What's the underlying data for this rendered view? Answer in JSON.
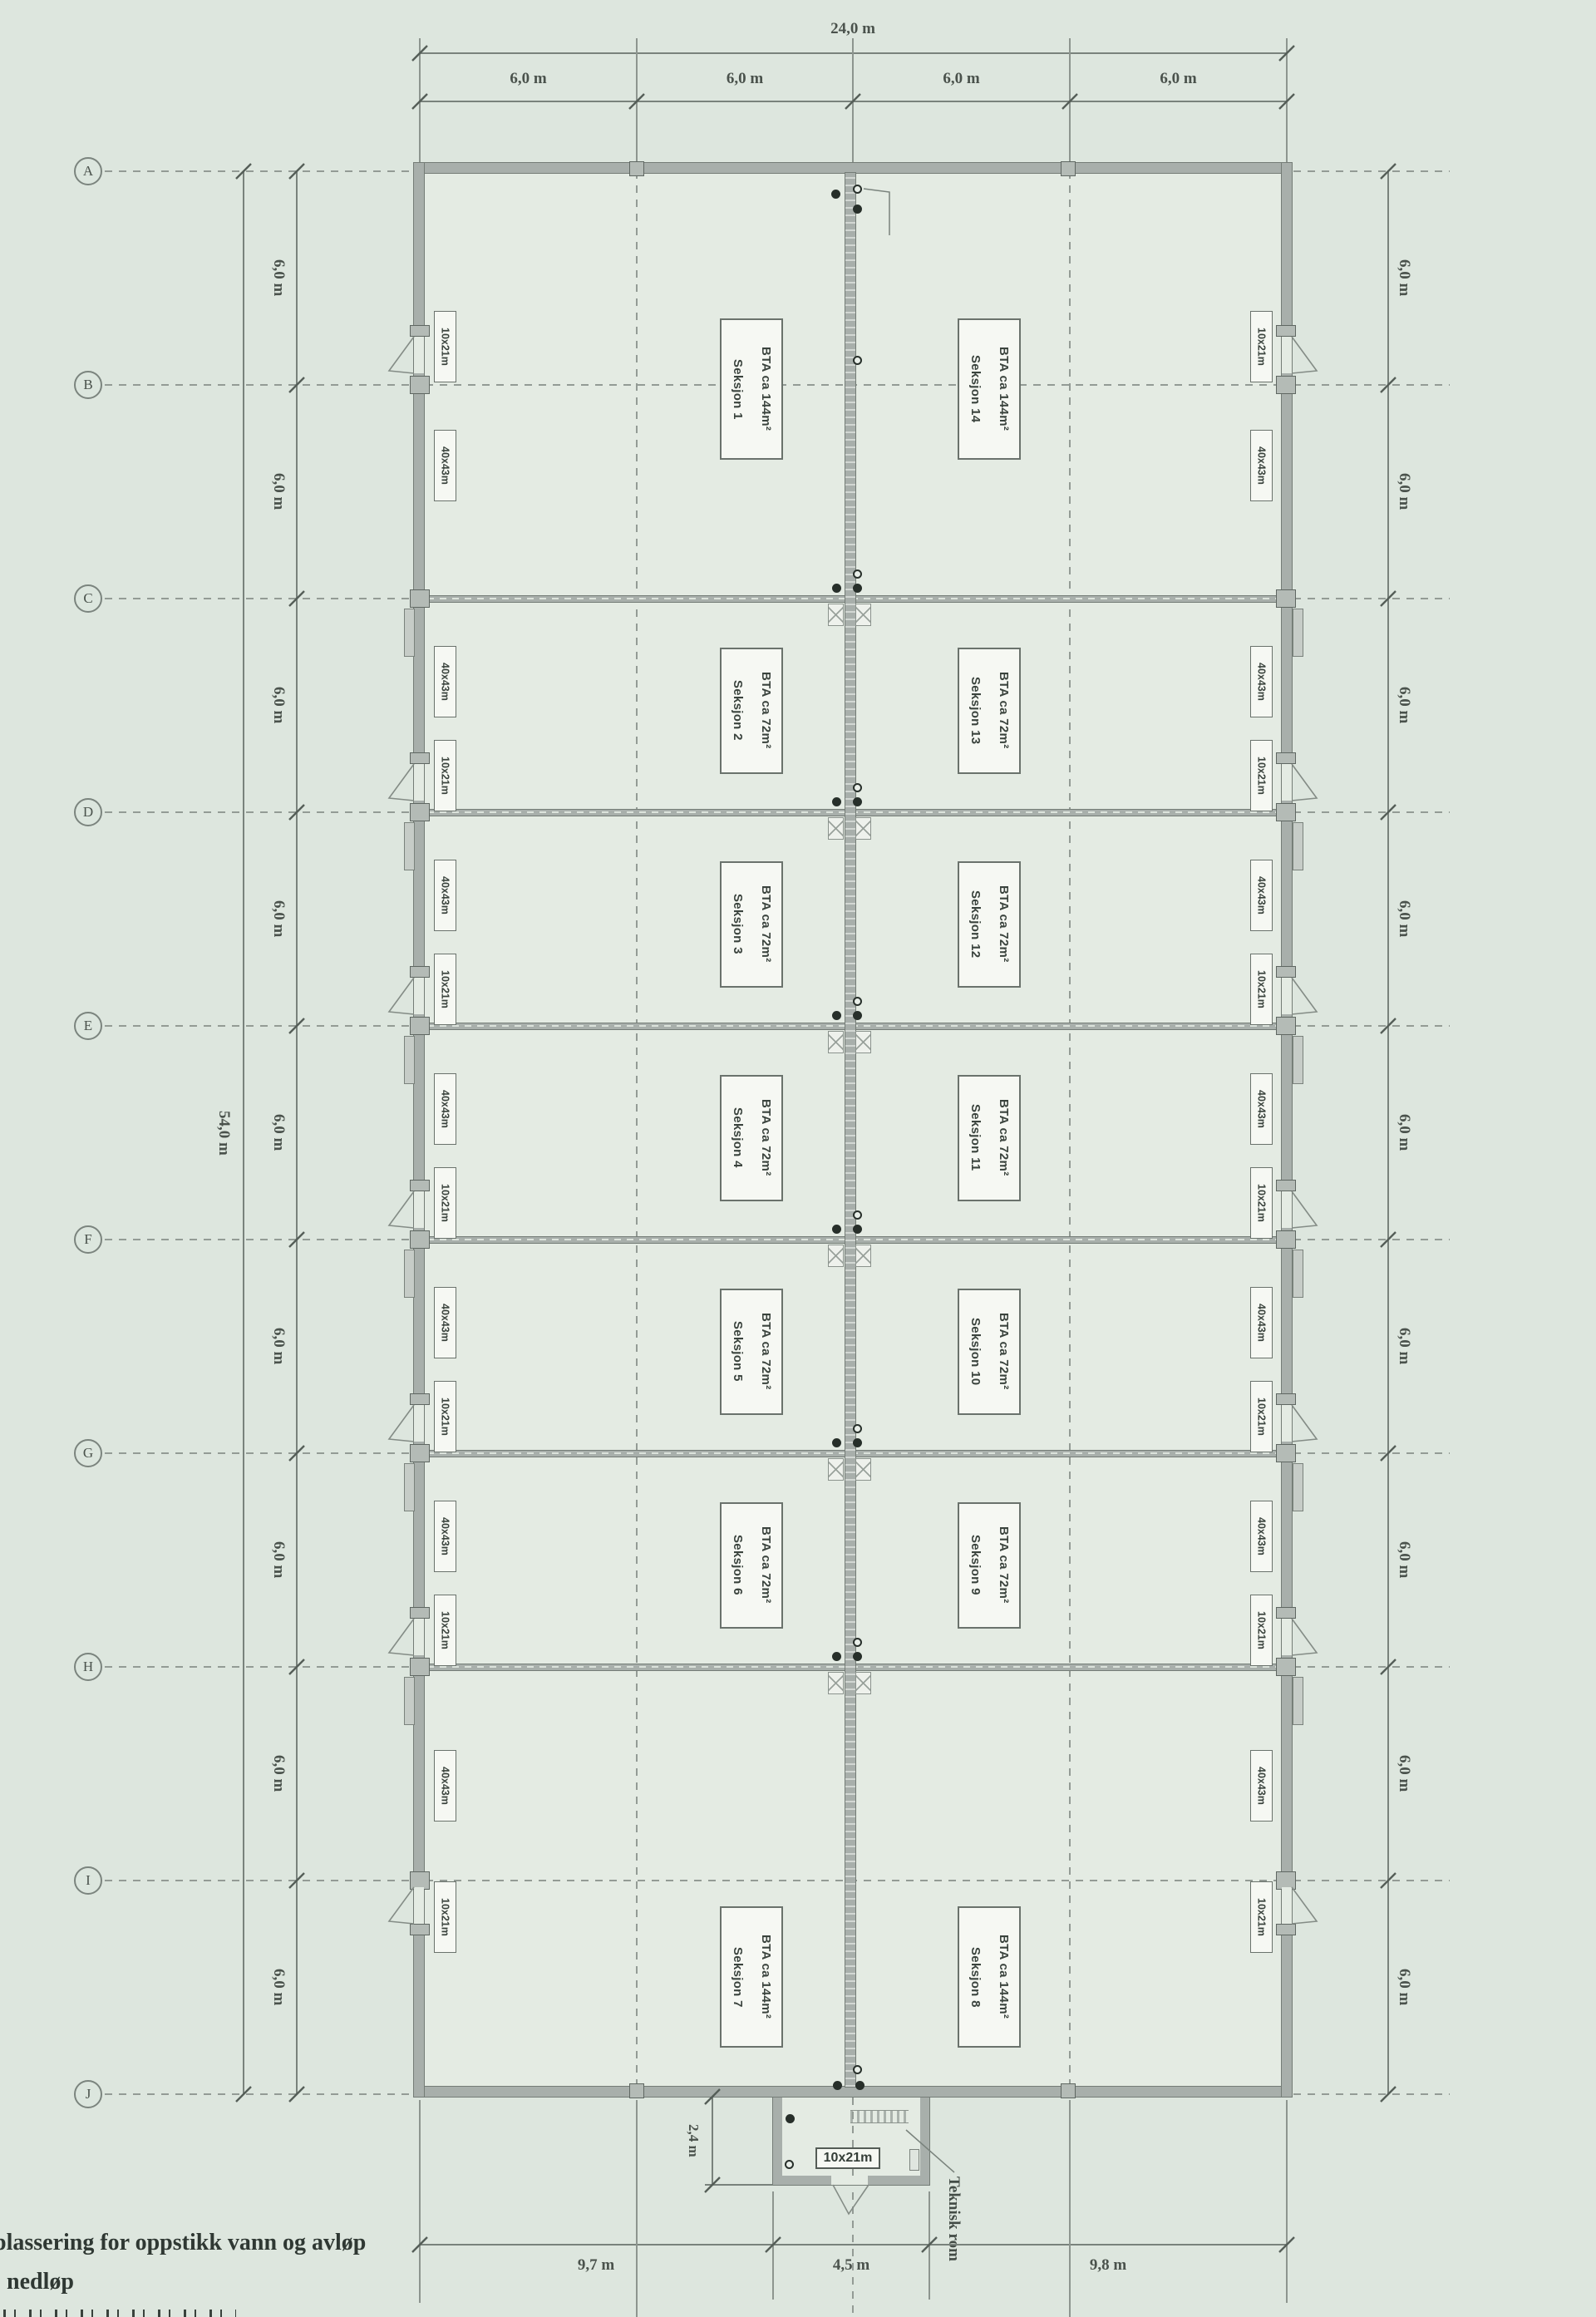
{
  "drawing": {
    "dims": {
      "top_total": "24,0 m",
      "top_bays": [
        "6,0 m",
        "6,0 m",
        "6,0 m",
        "6,0 m"
      ],
      "left_total": "54,0 m",
      "left_bays": [
        "6,0 m",
        "6,0 m",
        "6,0 m",
        "6,0 m",
        "6,0 m",
        "6,0 m",
        "6,0 m",
        "6,0 m",
        "6,0 m"
      ],
      "right_bays": [
        "6,0 m",
        "6,0 m",
        "6,0 m",
        "6,0 m",
        "6,0 m",
        "6,0 m",
        "6,0 m",
        "6,0 m",
        "6,0 m"
      ],
      "bottom_segments": [
        "9,7 m",
        "4,5 m",
        "9,8 m"
      ],
      "teknisk_depth": "2,4 m"
    },
    "grid_rows": [
      "A",
      "B",
      "C",
      "D",
      "E",
      "F",
      "G",
      "H",
      "I",
      "J"
    ],
    "sections": [
      {
        "name": "Seksjon 1",
        "area": "BTA ca 144m²",
        "column": "left",
        "rows": "A-C"
      },
      {
        "name": "Seksjon 2",
        "area": "BTA ca 72m²",
        "column": "left",
        "rows": "C-D"
      },
      {
        "name": "Seksjon 3",
        "area": "BTA ca 72m²",
        "column": "left",
        "rows": "D-E"
      },
      {
        "name": "Seksjon 4",
        "area": "BTA ca 72m²",
        "column": "left",
        "rows": "E-F"
      },
      {
        "name": "Seksjon 5",
        "area": "BTA ca 72m²",
        "column": "left",
        "rows": "F-G"
      },
      {
        "name": "Seksjon 6",
        "area": "BTA ca 72m²",
        "column": "left",
        "rows": "G-H"
      },
      {
        "name": "Seksjon 7",
        "area": "BTA ca 144m²",
        "column": "left",
        "rows": "H-J"
      },
      {
        "name": "Seksjon 8",
        "area": "BTA ca 144m²",
        "column": "right",
        "rows": "H-J"
      },
      {
        "name": "Seksjon 9",
        "area": "BTA ca 72m²",
        "column": "right",
        "rows": "G-H"
      },
      {
        "name": "Seksjon 10",
        "area": "BTA ca 72m²",
        "column": "right",
        "rows": "F-G"
      },
      {
        "name": "Seksjon 11",
        "area": "BTA ca 72m²",
        "column": "right",
        "rows": "E-F"
      },
      {
        "name": "Seksjon 12",
        "area": "BTA ca 72m²",
        "column": "right",
        "rows": "D-E"
      },
      {
        "name": "Seksjon 13",
        "area": "BTA ca 72m²",
        "column": "right",
        "rows": "C-D"
      },
      {
        "name": "Seksjon 14",
        "area": "BTA ca 144m²",
        "column": "right",
        "rows": "A-C"
      }
    ],
    "wall_labels": {
      "door": "10x21m",
      "gate": "40x43m"
    },
    "annotations": {
      "lufting": "lufting",
      "teknisk_rom": "Teknisk rom",
      "teknisk_size": "10x21m"
    },
    "legend": {
      "items": [
        {
          "symbol": "filled-dot",
          "label": "plassering for oppstikk vann og avløp"
        },
        {
          "symbol": "open-dot",
          "label": "nedløp"
        }
      ]
    },
    "colors": {
      "paper": "#dde6de",
      "interior": "#e4ebe3",
      "wall": "#a8afab",
      "line": "#79827c",
      "text": "#3e4742",
      "label_bg": "#f6f8f3"
    }
  }
}
